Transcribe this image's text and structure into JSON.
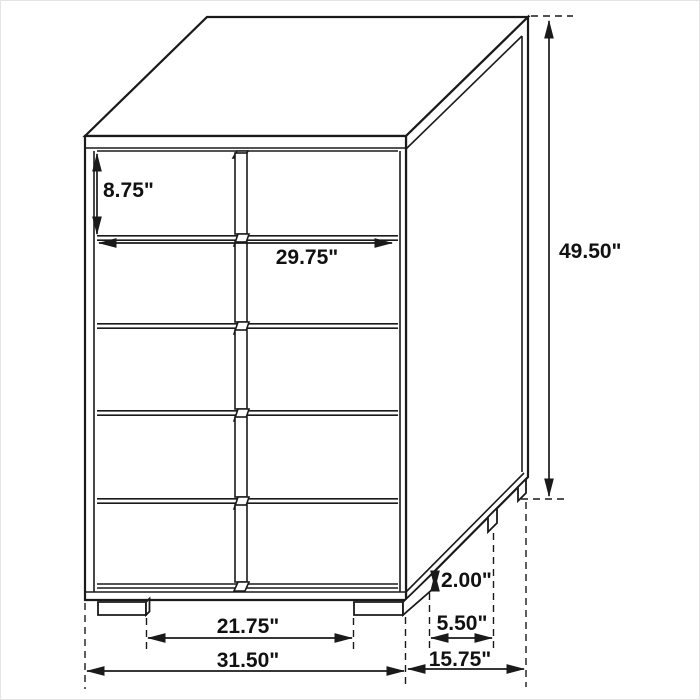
{
  "diagram": {
    "type": "furniture-dimension-drawing",
    "subject": "5-drawer chest / tall dresser isometric line drawing",
    "drawer_rows": 5,
    "colors": {
      "line": "#1a1a1a",
      "background": "#ffffff",
      "label_text": "#111111"
    },
    "labels": {
      "drawer_height": "8.75\"",
      "drawer_width": "29.75\"",
      "overall_height": "49.50\"",
      "leg_height": "2.00\"",
      "side_leg_spacing": "5.50\"",
      "front_leg_spacing": "21.75\"",
      "overall_width": "31.50\"",
      "overall_depth": "15.75\""
    }
  }
}
